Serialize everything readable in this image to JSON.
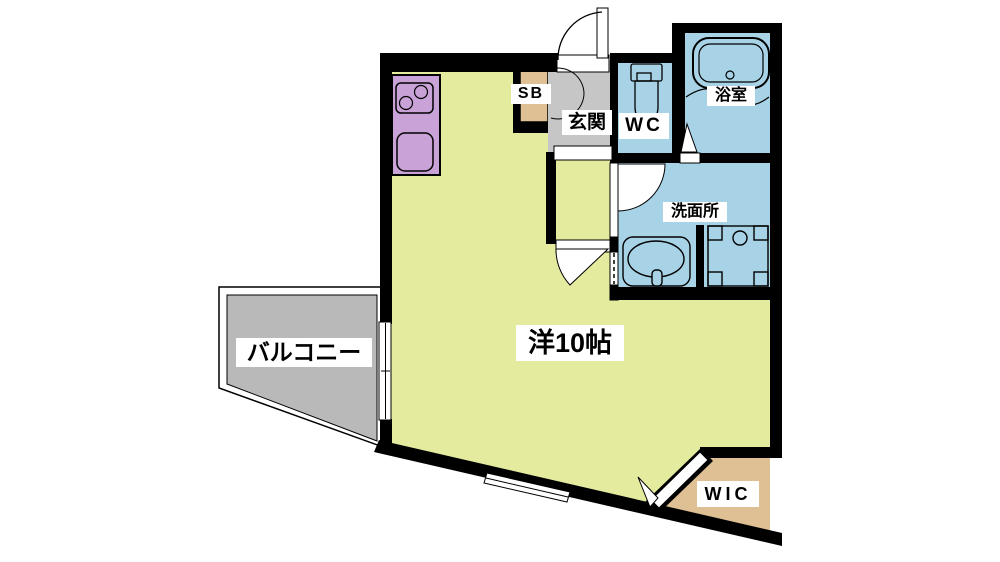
{
  "floorplan": {
    "rooms": {
      "main_room": {
        "label": "洋10帖"
      },
      "balcony": {
        "label": "バルコニー"
      },
      "entrance": {
        "label": "玄関"
      },
      "shoe_box": {
        "label": "SB"
      },
      "toilet": {
        "label": "WC"
      },
      "bathroom": {
        "label": "浴室"
      },
      "washroom": {
        "label": "洗面所"
      },
      "walk_in_closet": {
        "label": "WIC"
      }
    },
    "fixtures": {
      "stove": "stove-icon",
      "kitchen_sink": "kitchen-sink-icon",
      "toilet": "toilet-icon",
      "bathtub": "bathtub-icon",
      "washbasin": "washbasin-icon",
      "washing_machine": "washing-machine-icon"
    },
    "colors": {
      "flooring": "#e5eb9e",
      "kitchen": "#c9a2d8",
      "wet_area": "#a8d3e6",
      "entrance_floor": "#c6c6c6",
      "balcony_floor": "#b9b9b9",
      "closet": "#dec094",
      "wall": "#000000",
      "label_bg": "#ffffff"
    }
  }
}
